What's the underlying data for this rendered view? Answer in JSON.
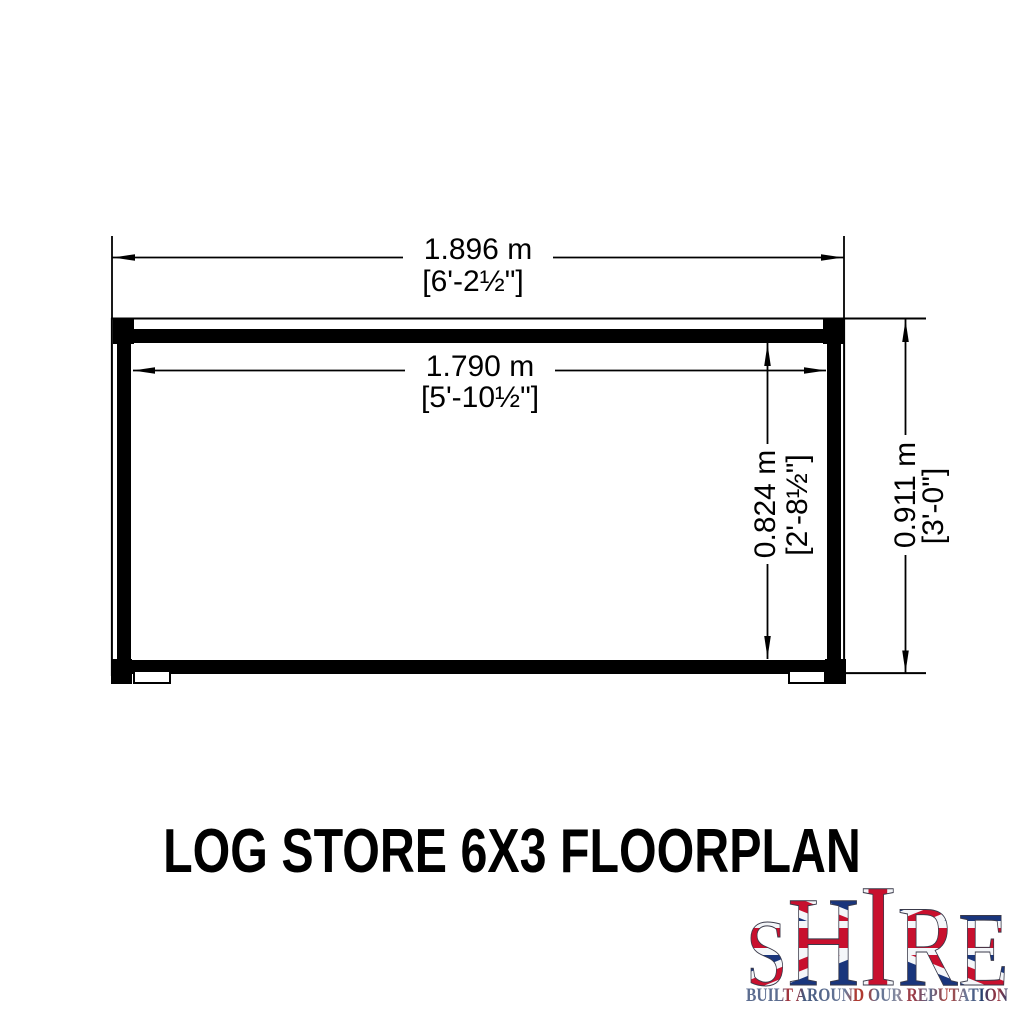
{
  "title": "LOG STORE 6X3 FLOORPLAN",
  "dimensions": {
    "outer_width": {
      "metric": "1.896 m",
      "imperial": "[6'-2½\"]"
    },
    "inner_width": {
      "metric": "1.790 m",
      "imperial": "[5'-10½\"]"
    },
    "inner_depth": {
      "metric": "0.824 m",
      "imperial": "[2'-8½\"]"
    },
    "outer_depth": {
      "metric": "0.911 m",
      "imperial": "[3'-0\"]"
    }
  },
  "logo": {
    "letters": [
      "S",
      "H",
      "I",
      "R",
      "E"
    ],
    "tagline": "BUILT AROUND OUR REPUTATION",
    "flag_red": "#C8102E",
    "flag_blue": "#19357C",
    "flag_white": "#F4F6F9",
    "tagline_blue": "#5C6D90",
    "tagline_red": "#A3333B"
  },
  "colors": {
    "line": "#000000",
    "background": "#FFFFFF"
  }
}
